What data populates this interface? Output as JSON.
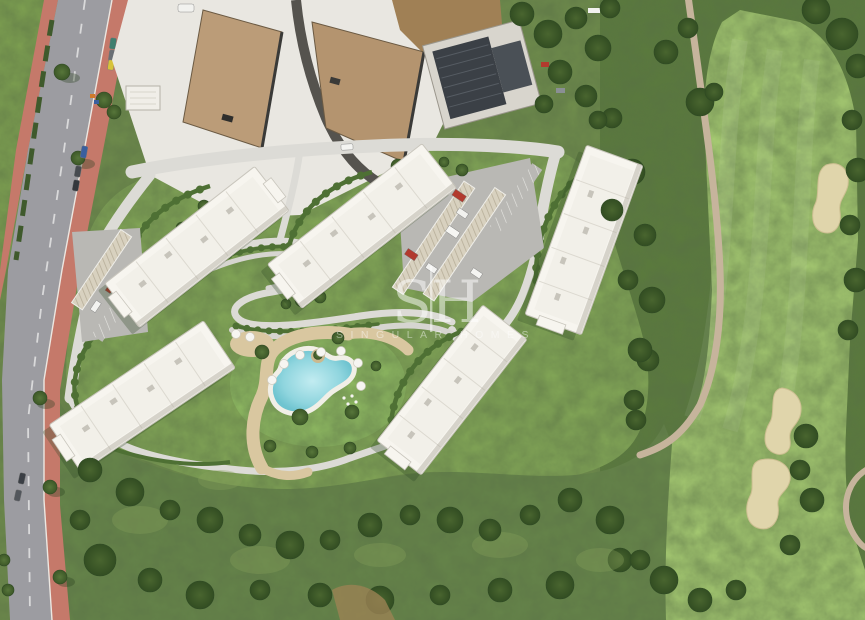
{
  "watermark": {
    "monogram_left": "S",
    "monogram_divider": "|",
    "monogram_right": "H",
    "subtitle": "SINGULAR HOMES"
  },
  "colors": {
    "scrub_green": "#6f8c4c",
    "scrub_dark": "#66854a",
    "rough_green": "#5a7a3d",
    "fairway_green": "#a4c871",
    "grass_green": "#7fa251",
    "lawn_green": "#83a757",
    "pool_lawn": "#8fba62",
    "hedge_green": "#4e7034",
    "path_light": "#dcdbd6",
    "sand_path": "#d9c7a0",
    "bunker_sand": "#e0d5ab",
    "cart_path": "#c6b49c",
    "road_asphalt": "#9c9ca1",
    "sidewalk_terracotta": "#c5796a",
    "dust_ground": "#e9e7e1",
    "graded_earth": "#bb9c78",
    "graded_earth_dark": "#b4946f",
    "construction_slab": "#3b4046",
    "pool_water": "#85d0da",
    "building_white": "#f7f5ef",
    "watermark_white": "#ffffff"
  }
}
